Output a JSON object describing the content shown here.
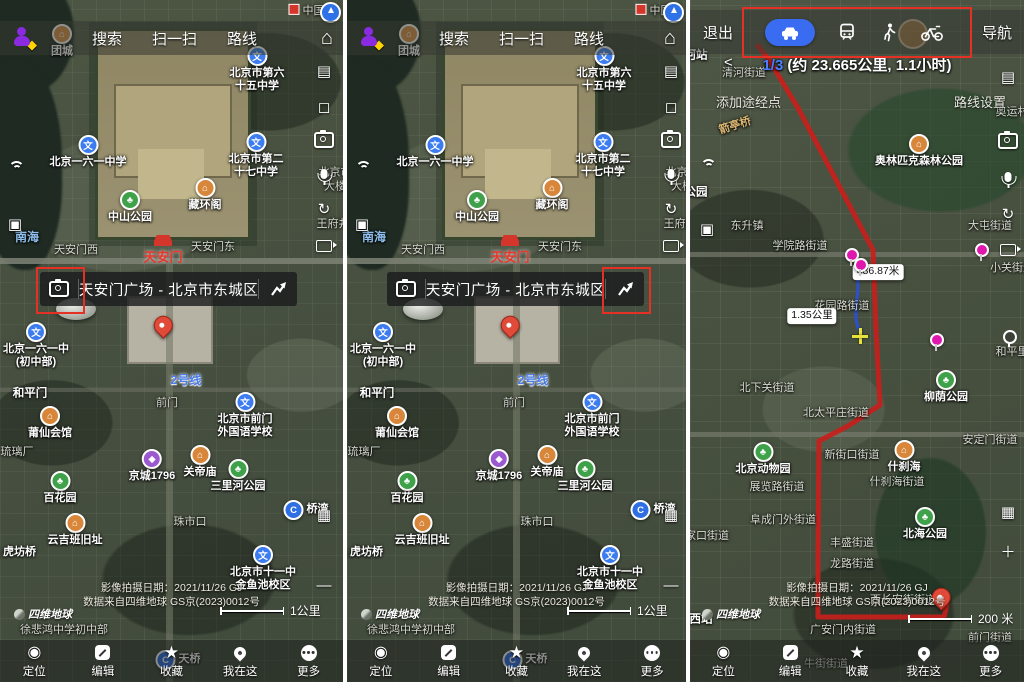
{
  "colors": {
    "accent_blue": "#3a6cf2",
    "route_red": "#d21f1f",
    "highlight_red": "#e43025",
    "subway_blue": "#2f6fe4"
  },
  "top_bar": {
    "menu": [
      "搜索",
      "扫一扫",
      "路线"
    ],
    "home_icon": "home",
    "avatar_icon": "user-avatar",
    "compass_icon": "compass"
  },
  "place_bar": {
    "title": "天安门广场 - 北京市东城区",
    "left_icon": "camera",
    "right_icon": "route-arrow"
  },
  "bottom_toolbar": {
    "items": [
      {
        "icon": "locate",
        "label": "定位"
      },
      {
        "icon": "edit",
        "label": "编辑"
      },
      {
        "icon": "star",
        "label": "收藏"
      },
      {
        "icon": "pin",
        "label": "我在这"
      },
      {
        "icon": "more",
        "label": "更多"
      }
    ]
  },
  "attribution": {
    "line1": "影像拍摄日期：2021/11/26 GJ",
    "line2": "数据来自四维地球 GS京(2023)0012号",
    "logo": "四维地球"
  },
  "scales": {
    "city": "1公里",
    "route": "200 米"
  },
  "route_panel": {
    "exit": "退出",
    "navigate": "导航",
    "prev": "<",
    "modes": [
      {
        "name": "car",
        "selected": true
      },
      {
        "name": "transit",
        "selected": false
      },
      {
        "name": "walk",
        "selected": false
      },
      {
        "name": "bike",
        "selected": false
      }
    ],
    "route_index": "1/3",
    "route_summary": "(约 23.665公里, 1.1小时)",
    "add_waypoint": "添加途经点",
    "route_settings": "路线设置",
    "walk_segment": "486.87米",
    "drive_segment": "1.35公里"
  },
  "city_map_labels": [
    {
      "t": "中国美",
      "x": 312,
      "y": 11,
      "k": "redsq"
    },
    {
      "t": "团城",
      "x": 62,
      "y": 30,
      "k": "historic"
    },
    {
      "t": "北京市第六\n十五中学",
      "x": 257,
      "y": 52,
      "k": "school"
    },
    {
      "t": "北京一六一中学",
      "x": 88,
      "y": 141,
      "k": "school"
    },
    {
      "t": "北京市第二\n十七中学",
      "x": 256,
      "y": 138,
      "k": "school"
    },
    {
      "t": "中山公园",
      "x": 130,
      "y": 196,
      "k": "park"
    },
    {
      "t": "藏环阁",
      "x": 205,
      "y": 184,
      "k": "historic"
    },
    {
      "t": "北京市\n大楼",
      "x": 335,
      "y": 180,
      "k": "area"
    },
    {
      "t": "王府井",
      "x": 333,
      "y": 224,
      "k": "area"
    },
    {
      "t": "南海",
      "x": 27,
      "y": 238,
      "k": "water"
    },
    {
      "t": "天安门西",
      "x": 76,
      "y": 250,
      "k": "area"
    },
    {
      "t": "天安门东",
      "x": 213,
      "y": 247,
      "k": "area"
    },
    {
      "t": "天安门",
      "x": 163,
      "y": 250,
      "k": "gate"
    },
    {
      "t": "北京一六一中\n(初中部)",
      "x": 36,
      "y": 328,
      "k": "school"
    },
    {
      "t": "和平门",
      "x": 30,
      "y": 394,
      "k": "white"
    },
    {
      "t": "2号线",
      "x": 186,
      "y": 381,
      "k": "line2"
    },
    {
      "t": "前门",
      "x": 167,
      "y": 403,
      "k": "area"
    },
    {
      "t": "北京市前门\n外国语学校",
      "x": 245,
      "y": 398,
      "k": "school"
    },
    {
      "t": "莆仙会馆",
      "x": 50,
      "y": 412,
      "k": "historic"
    },
    {
      "t": "琉璃厂",
      "x": 17,
      "y": 452,
      "k": "area"
    },
    {
      "t": "京城1796",
      "x": 152,
      "y": 455,
      "k": "shop"
    },
    {
      "t": "关帝庙",
      "x": 200,
      "y": 451,
      "k": "historic"
    },
    {
      "t": "三里河公园",
      "x": 238,
      "y": 465,
      "k": "park"
    },
    {
      "t": "百花园",
      "x": 60,
      "y": 477,
      "k": "park"
    },
    {
      "t": "云吉班旧址",
      "x": 75,
      "y": 519,
      "k": "historic"
    },
    {
      "t": "珠市口",
      "x": 190,
      "y": 522,
      "k": "area"
    },
    {
      "t": "桥湾",
      "x": 306,
      "y": 510,
      "k": "subway"
    },
    {
      "t": "北京市十一中\n金鱼池校区",
      "x": 263,
      "y": 551,
      "k": "school"
    },
    {
      "t": "虎坊桥",
      "x": 8,
      "y": 553,
      "k": "subway"
    },
    {
      "t": "徐悲鸿中学初中部",
      "x": 64,
      "y": 630,
      "k": "area"
    },
    {
      "t": "天桥",
      "x": 178,
      "y": 660,
      "k": "subway"
    }
  ],
  "route_map_labels": [
    {
      "t": "河站",
      "x": 6,
      "y": 56,
      "k": "white"
    },
    {
      "t": "清河街道",
      "x": 54,
      "y": 73,
      "k": "area"
    },
    {
      "t": "箭亭桥",
      "x": 45,
      "y": 126,
      "k": "bridge"
    },
    {
      "t": "奥运村",
      "x": 322,
      "y": 112,
      "k": "area"
    },
    {
      "t": "奥林匹克森林公园",
      "x": 229,
      "y": 140,
      "k": "historic"
    },
    {
      "t": "公园",
      "x": 6,
      "y": 193,
      "k": "white"
    },
    {
      "t": "东升镇",
      "x": 57,
      "y": 226,
      "k": "area"
    },
    {
      "t": "大屯街道",
      "x": 300,
      "y": 226,
      "k": "area"
    },
    {
      "t": "学院路街道",
      "x": 110,
      "y": 246,
      "k": "area"
    },
    {
      "t": "小关街道",
      "x": 322,
      "y": 268,
      "k": "area"
    },
    {
      "t": "486.87米",
      "x": 188,
      "y": 272,
      "k": "measure"
    },
    {
      "t": "花园路街道",
      "x": 152,
      "y": 306,
      "k": "area"
    },
    {
      "t": "1.35公里",
      "x": 122,
      "y": 316,
      "k": "measure"
    },
    {
      "t": "和平里",
      "x": 322,
      "y": 352,
      "k": "area"
    },
    {
      "t": "柳荫公园",
      "x": 256,
      "y": 376,
      "k": "park"
    },
    {
      "t": "北下关街道",
      "x": 77,
      "y": 388,
      "k": "area"
    },
    {
      "t": "北太平庄街道",
      "x": 146,
      "y": 413,
      "k": "area"
    },
    {
      "t": "安定门街道",
      "x": 300,
      "y": 440,
      "k": "area"
    },
    {
      "t": "北京动物园",
      "x": 73,
      "y": 448,
      "k": "park"
    },
    {
      "t": "新街口街道",
      "x": 162,
      "y": 455,
      "k": "area"
    },
    {
      "t": "什刹海",
      "x": 214,
      "y": 446,
      "k": "historic"
    },
    {
      "t": "什刹海街道",
      "x": 207,
      "y": 482,
      "k": "area"
    },
    {
      "t": "展览路街道",
      "x": 87,
      "y": 487,
      "k": "area"
    },
    {
      "t": "阜成门外街道",
      "x": 93,
      "y": 520,
      "k": "area"
    },
    {
      "t": "家口街道",
      "x": 17,
      "y": 536,
      "k": "area"
    },
    {
      "t": "北海公园",
      "x": 235,
      "y": 513,
      "k": "park"
    },
    {
      "t": "丰盛街道",
      "x": 162,
      "y": 543,
      "k": "area"
    },
    {
      "t": "龙路街道",
      "x": 162,
      "y": 564,
      "k": "area"
    },
    {
      "t": "西长安街街道",
      "x": 213,
      "y": 600,
      "k": "area"
    },
    {
      "t": "西站",
      "x": 11,
      "y": 620,
      "k": "white"
    },
    {
      "t": "广安门内街道",
      "x": 153,
      "y": 630,
      "k": "area"
    },
    {
      "t": "前门街道",
      "x": 300,
      "y": 638,
      "k": "area"
    },
    {
      "t": "牛街街道",
      "x": 136,
      "y": 664,
      "k": "area"
    }
  ],
  "city_tools_right": [
    {
      "k": "layers",
      "y": 64
    },
    {
      "k": "frame",
      "y": 100
    },
    {
      "k": "camera",
      "y": 132
    },
    {
      "k": "mic",
      "y": 167
    },
    {
      "k": "rotate",
      "y": 202
    },
    {
      "k": "video",
      "y": 240
    },
    {
      "k": "qr",
      "y": 508
    },
    {
      "k": "minus",
      "y": 578
    }
  ],
  "city_tools_left": [
    {
      "k": "signal",
      "y": 160
    },
    {
      "k": "cube",
      "y": 217
    }
  ],
  "route_tools_right": [
    {
      "k": "layers",
      "y": 70
    },
    {
      "k": "camera",
      "y": 133
    },
    {
      "k": "mic",
      "y": 170
    },
    {
      "k": "rotate",
      "y": 207
    },
    {
      "k": "video",
      "y": 244
    },
    {
      "k": "qr",
      "y": 505
    },
    {
      "k": "plus",
      "y": 545
    }
  ],
  "route_tools_left": [
    {
      "k": "signal",
      "y": 158
    },
    {
      "k": "cube",
      "y": 222
    }
  ],
  "city_pins": [
    {
      "x": 170,
      "y": 332,
      "k": "dest"
    }
  ],
  "route_pins": [
    {
      "x": 162,
      "y": 262,
      "k": "magenta"
    },
    {
      "x": 171,
      "y": 272,
      "k": "magenta"
    },
    {
      "x": 292,
      "y": 257,
      "k": "magenta"
    },
    {
      "x": 247,
      "y": 347,
      "k": "magenta"
    },
    {
      "x": 320,
      "y": 344,
      "k": "whitepin"
    },
    {
      "x": 170,
      "y": 336,
      "k": "cross"
    },
    {
      "x": 258,
      "y": 604,
      "k": "dest"
    }
  ]
}
